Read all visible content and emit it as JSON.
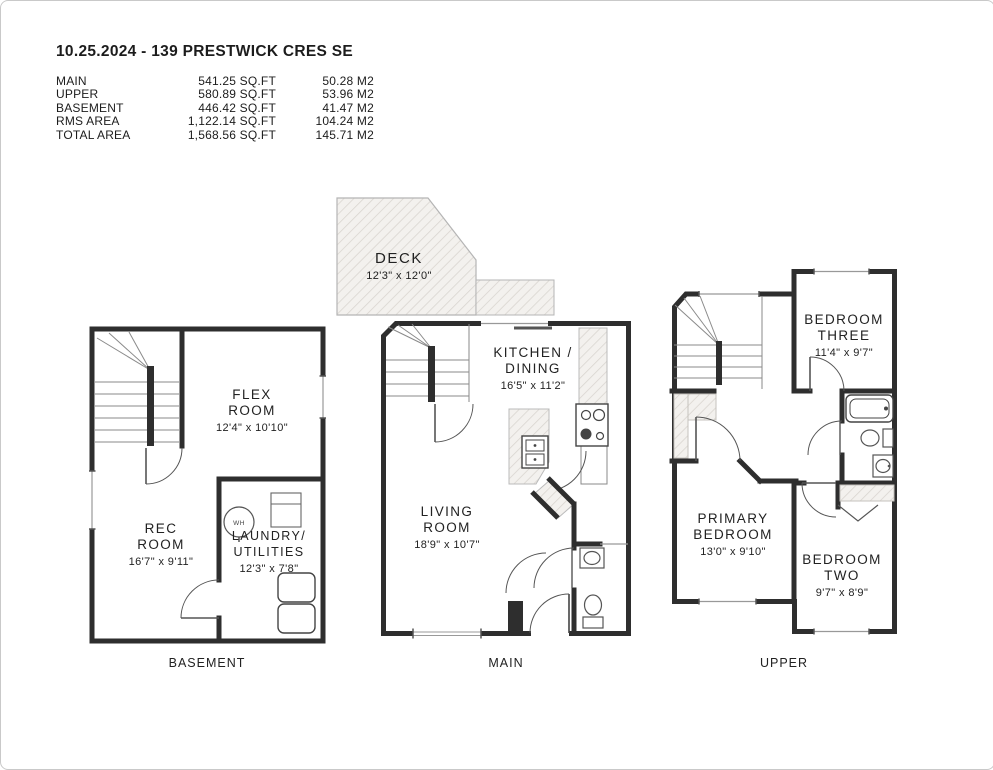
{
  "header": {
    "title": "10.25.2024 - 139 PRESTWICK CRES SE",
    "area_table": {
      "rows": [
        {
          "label": "MAIN",
          "sqft": "541.25 SQ.FT",
          "m2": "50.28 M2"
        },
        {
          "label": "UPPER",
          "sqft": "580.89 SQ.FT",
          "m2": "53.96 M2"
        },
        {
          "label": "BASEMENT",
          "sqft": "446.42 SQ.FT",
          "m2": "41.47 M2"
        },
        {
          "label": "RMS AREA",
          "sqft": "1,122.14 SQ.FT",
          "m2": "104.24 M2"
        },
        {
          "label": "TOTAL AREA",
          "sqft": "1,568.56 SQ.FT",
          "m2": "145.71 M2"
        }
      ]
    }
  },
  "floors": {
    "basement": {
      "label": "BASEMENT",
      "rooms": {
        "flex": {
          "name_line1": "FLEX",
          "name_line2": "ROOM",
          "dims": "12'4\" x 10'10\""
        },
        "rec": {
          "name_line1": "REC",
          "name_line2": "ROOM",
          "dims": "16'7\" x 9'11\""
        },
        "laundry": {
          "name_line1": "LAUNDRY/",
          "name_line2": "UTILITIES",
          "dims": "12'3\" x 7'8\""
        }
      },
      "fixtures": {
        "water_heater": "WH"
      }
    },
    "main": {
      "label": "MAIN",
      "rooms": {
        "deck": {
          "name": "DECK",
          "dims": "12'3\" x 12'0\""
        },
        "kitchen": {
          "name_line1": "KITCHEN /",
          "name_line2": "DINING",
          "dims": "16'5\" x 11'2\""
        },
        "living": {
          "name_line1": "LIVING",
          "name_line2": "ROOM",
          "dims": "18'9\" x 10'7\""
        }
      }
    },
    "upper": {
      "label": "UPPER",
      "rooms": {
        "bedroom_three": {
          "name_line1": "BEDROOM",
          "name_line2": "THREE",
          "dims": "11'4\" x 9'7\""
        },
        "primary": {
          "name_line1": "PRIMARY",
          "name_line2": "BEDROOM",
          "dims": "13'0\" x 9'10\""
        },
        "bedroom_two": {
          "name_line1": "BEDROOM",
          "name_line2": "TWO",
          "dims": "9'7\" x 8'9\""
        }
      }
    }
  },
  "colors": {
    "wall": "#2e2e2e",
    "thin_line": "#8a8a8a",
    "hatch_line": "#d8d4ce",
    "hatch_bg": "#f3f1ee"
  }
}
